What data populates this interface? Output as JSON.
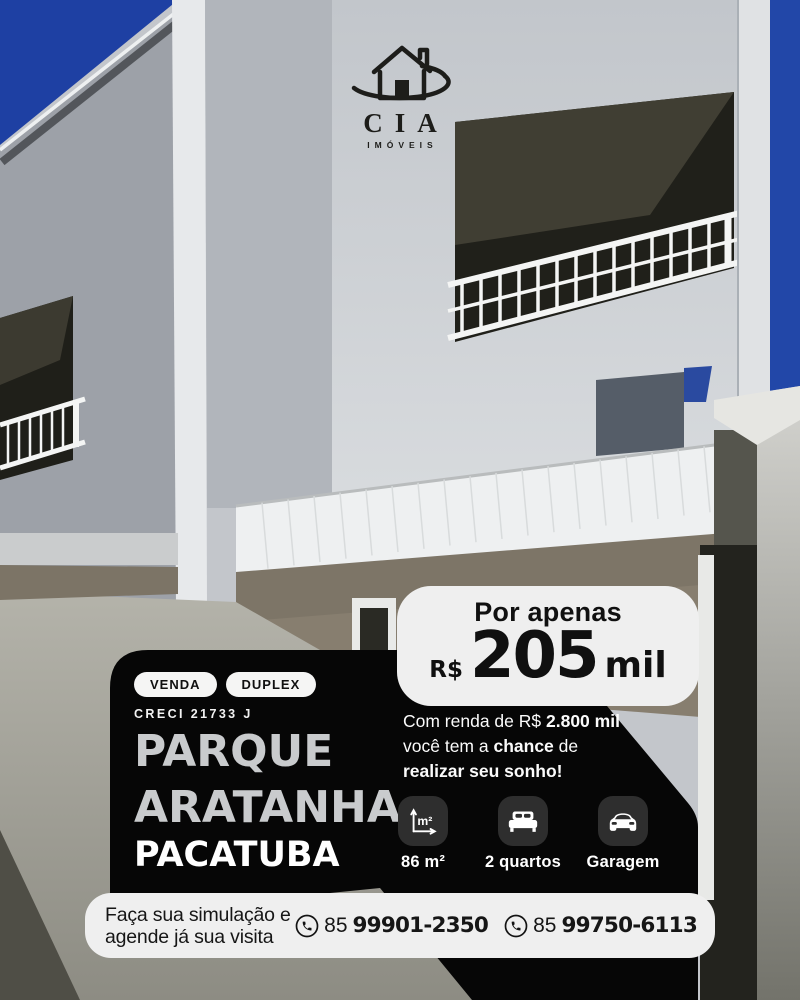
{
  "brand": {
    "name": "CIA",
    "subtitle": "IMÓVEIS"
  },
  "price": {
    "intro": "Por apenas",
    "currency": "R$",
    "amount": "205",
    "unit": "mil"
  },
  "listing": {
    "badge_sale": "VENDA",
    "badge_type": "DUPLEX",
    "creci": "CRECI 21733 J",
    "title_line1": "PARQUE",
    "title_line2": "ARATANHA",
    "location": "PACATUBA"
  },
  "pitch": {
    "l1a": "Com renda de R$ ",
    "l1b": "2.800 mil",
    "l2a": "você tem a ",
    "l2b": "chance",
    "l2c": " de",
    "l3": "realizar seu sonho!"
  },
  "features": [
    {
      "icon": "area-icon",
      "label": "86 m²"
    },
    {
      "icon": "bed-icon",
      "label": "2 quartos"
    },
    {
      "icon": "car-icon",
      "label": "Garagem"
    }
  ],
  "contact": {
    "cta_line1": "Faça sua simulação e",
    "cta_line2": "agende já sua visita",
    "phones": [
      {
        "area_code": "85",
        "number": "99901-2350"
      },
      {
        "area_code": "85",
        "number": "99750-6113"
      }
    ]
  },
  "colors": {
    "sky_blue": "#1e40a3",
    "panel_black": "#060606",
    "card_light": "#efefef",
    "tile_gray": "#2e2e2e",
    "title_gray": "#c9cbcd",
    "text_white": "#ffffff"
  }
}
